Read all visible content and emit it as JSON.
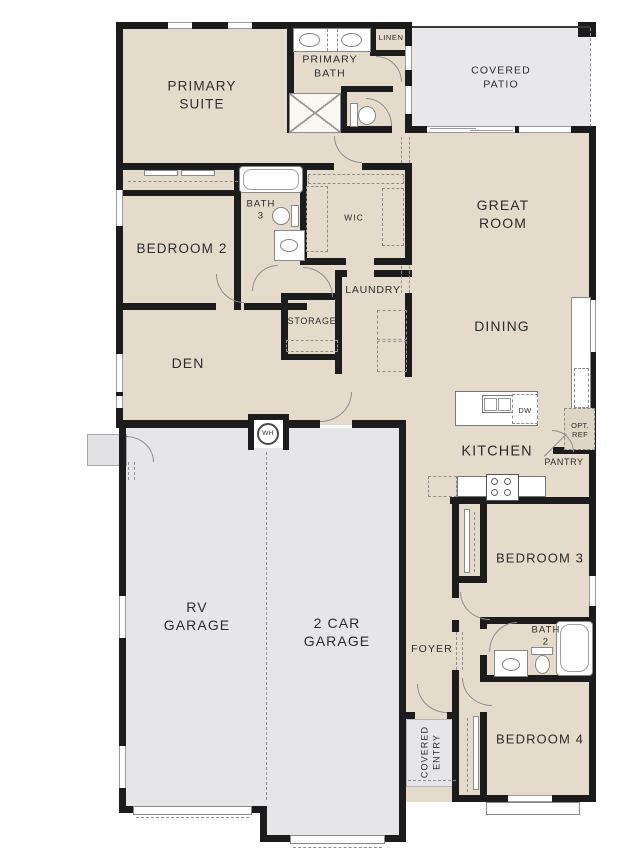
{
  "document": {
    "type": "residential floor plan"
  },
  "rooms": {
    "primary_suite": "PRIMARY\nSUITE",
    "primary_bath": "PRIMARY\nBATH",
    "linen": "LINEN",
    "covered_patio": "COVERED\nPATIO",
    "great_room": "GREAT\nROOM",
    "bedroom_2": "BEDROOM 2",
    "bath_3": "BATH\n3",
    "wic": "WIC",
    "laundry": "LAUNDRY",
    "storage": "STORAGE",
    "den": "DEN",
    "dining": "DINING",
    "kitchen": "KITCHEN",
    "pantry": "PANTRY",
    "bedroom_3": "BEDROOM 3",
    "bath_2": "BATH\n2",
    "bedroom_4": "BEDROOM 4",
    "foyer": "FOYER",
    "covered_entry": "COVERED\nENTRY",
    "rv_garage": "RV\nGARAGE",
    "two_car_garage": "2 CAR\nGARAGE"
  },
  "appliances": {
    "dishwasher": "DW",
    "optional_refrigerator": "OPT.\nREF",
    "water_heater": "WH"
  },
  "colors": {
    "floor_tan": "#e4dbcb",
    "concrete_gray": "#e8e8ea",
    "wall_black": "#1c1c1c",
    "fixture_white": "#ffffff",
    "label_text": "#2c2c2c"
  }
}
